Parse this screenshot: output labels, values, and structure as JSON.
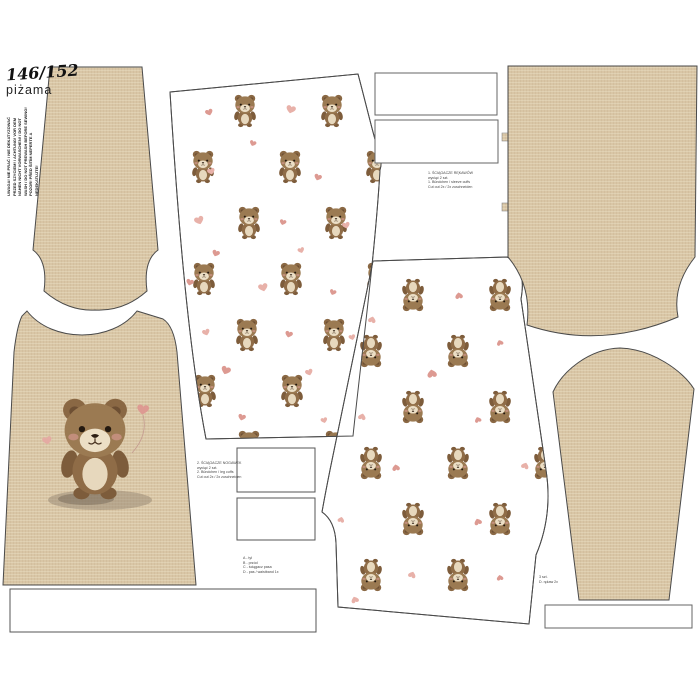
{
  "header": {
    "size_label": "146/152",
    "garment_label": "piżama"
  },
  "care_note": {
    "lines": [
      "UWAGA! NIE PRAĆ / NIE DEKATYZOWAĆ",
      "PRZED SZYCIEM! / ACHTUNG! VOR DEM",
      "NÄHEN NICHT VORWASCHEN! / DO NOT",
      "WASH / DO NOT PREWASH BEFORE SEWING!",
      "POZOR! PŘED ŠITÍM NEPERTE A",
      "NEDEKATUJTE!"
    ]
  },
  "piece_labels": {
    "sleeve_cuffs": {
      "lines": [
        "1. ŚCIĄGACZE RĘKAWÓW",
        "wyciąć 2 szt.",
        "1. Bündchen / sleeve cuffs",
        "Cut out 2x / 2x zuschneiden"
      ]
    },
    "leg_cuffs": {
      "lines": [
        "2. ŚCIĄGACZE NOGAWEK",
        "wyciąć 2 szt.",
        "2. Bündchen / leg cuffs",
        "Cut out 2x / 2x zuschneiden"
      ]
    },
    "legend": {
      "lines": [
        "A - tył",
        "B - przód",
        "C - ściągacz pasa",
        "D - pas / waistband 1x"
      ]
    },
    "sleeve_note": {
      "lines": [
        "3 szt.",
        "D. rękaw 2x"
      ]
    }
  },
  "colors": {
    "background": "#ffffff",
    "linen_beige": "#d9c6a6",
    "linen_weft": "#c9b28c",
    "linen_warp": "#efe3cb",
    "outline": "#4a4a4a",
    "bear_brown": "#9b7a52",
    "bear_dark": "#7d5c3b",
    "bear_cream": "#ecdfc6",
    "heart_pink": "#dd9a92",
    "text": "#222222"
  }
}
